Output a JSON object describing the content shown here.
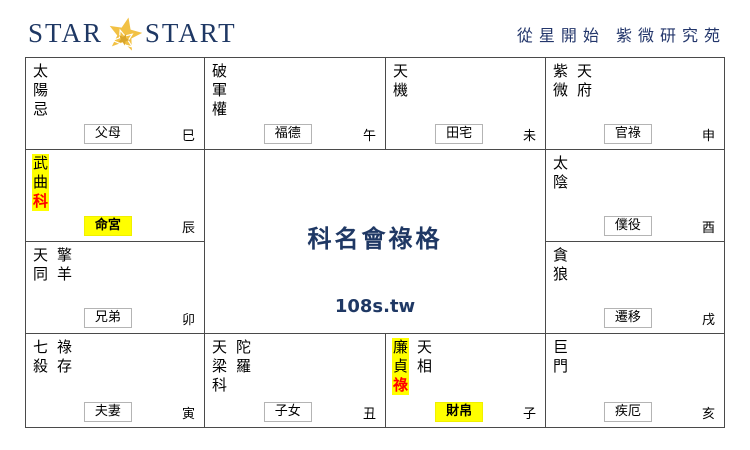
{
  "header": {
    "logo_left": "STAR",
    "logo_right": "START",
    "site_title": "從星開始 紫微研究苑"
  },
  "center": {
    "title": "科名會祿格",
    "url": "108s.tw"
  },
  "colors": {
    "navy": "#1f3864",
    "highlight_yellow": "#ffff00",
    "transform_red": "#ff0000",
    "grid_border": "#4a4a4a",
    "label_border": "#b4b4b4",
    "logo_gold": "#f2c144"
  },
  "cells": [
    {
      "key": "si",
      "palace": "父母",
      "palace_highlight": false,
      "branch": "巳",
      "stars": [
        {
          "highlight": false,
          "chars": [
            {
              "c": "太"
            },
            {
              "c": "陽"
            },
            {
              "c": "忌"
            }
          ]
        }
      ]
    },
    {
      "key": "wu",
      "palace": "福德",
      "palace_highlight": false,
      "branch": "午",
      "stars": [
        {
          "highlight": false,
          "chars": [
            {
              "c": "破"
            },
            {
              "c": "軍"
            },
            {
              "c": "權"
            }
          ]
        }
      ]
    },
    {
      "key": "wei",
      "palace": "田宅",
      "palace_highlight": false,
      "branch": "未",
      "stars": [
        {
          "highlight": false,
          "chars": [
            {
              "c": "天"
            },
            {
              "c": "機"
            }
          ]
        }
      ]
    },
    {
      "key": "shen",
      "palace": "官祿",
      "palace_highlight": false,
      "branch": "申",
      "stars": [
        {
          "highlight": false,
          "chars": [
            {
              "c": "紫"
            },
            {
              "c": "微"
            }
          ]
        },
        {
          "highlight": false,
          "chars": [
            {
              "c": "天"
            },
            {
              "c": "府"
            }
          ]
        }
      ]
    },
    {
      "key": "chen",
      "palace": "命宮",
      "palace_highlight": true,
      "branch": "辰",
      "stars": [
        {
          "highlight": true,
          "chars": [
            {
              "c": "武"
            },
            {
              "c": "曲"
            },
            {
              "c": "科",
              "red": true
            }
          ]
        }
      ]
    },
    {
      "key": "you",
      "palace": "僕役",
      "palace_highlight": false,
      "branch": "酉",
      "stars": [
        {
          "highlight": false,
          "chars": [
            {
              "c": "太"
            },
            {
              "c": "陰"
            }
          ]
        }
      ]
    },
    {
      "key": "mao",
      "palace": "兄弟",
      "palace_highlight": false,
      "branch": "卯",
      "stars": [
        {
          "highlight": false,
          "chars": [
            {
              "c": "天"
            },
            {
              "c": "同"
            }
          ]
        },
        {
          "highlight": false,
          "chars": [
            {
              "c": "擎"
            },
            {
              "c": "羊"
            }
          ]
        }
      ]
    },
    {
      "key": "xu",
      "palace": "遷移",
      "palace_highlight": false,
      "branch": "戌",
      "stars": [
        {
          "highlight": false,
          "chars": [
            {
              "c": "貪"
            },
            {
              "c": "狼"
            }
          ]
        }
      ]
    },
    {
      "key": "yin",
      "palace": "夫妻",
      "palace_highlight": false,
      "branch": "寅",
      "stars": [
        {
          "highlight": false,
          "chars": [
            {
              "c": "七"
            },
            {
              "c": "殺"
            }
          ]
        },
        {
          "highlight": false,
          "chars": [
            {
              "c": "祿"
            },
            {
              "c": "存"
            }
          ]
        }
      ]
    },
    {
      "key": "chou",
      "palace": "子女",
      "palace_highlight": false,
      "branch": "丑",
      "stars": [
        {
          "highlight": false,
          "chars": [
            {
              "c": "天"
            },
            {
              "c": "梁"
            },
            {
              "c": "科"
            }
          ]
        },
        {
          "highlight": false,
          "chars": [
            {
              "c": "陀"
            },
            {
              "c": "羅"
            }
          ]
        }
      ]
    },
    {
      "key": "zi",
      "palace": "財帛",
      "palace_highlight": true,
      "branch": "子",
      "stars": [
        {
          "highlight": true,
          "chars": [
            {
              "c": "廉"
            },
            {
              "c": "貞"
            },
            {
              "c": "祿",
              "red": true
            }
          ]
        },
        {
          "highlight": false,
          "chars": [
            {
              "c": "天"
            },
            {
              "c": "相"
            }
          ]
        }
      ]
    },
    {
      "key": "hai",
      "palace": "疾厄",
      "palace_highlight": false,
      "branch": "亥",
      "stars": [
        {
          "highlight": false,
          "chars": [
            {
              "c": "巨"
            },
            {
              "c": "門"
            }
          ]
        }
      ]
    }
  ]
}
